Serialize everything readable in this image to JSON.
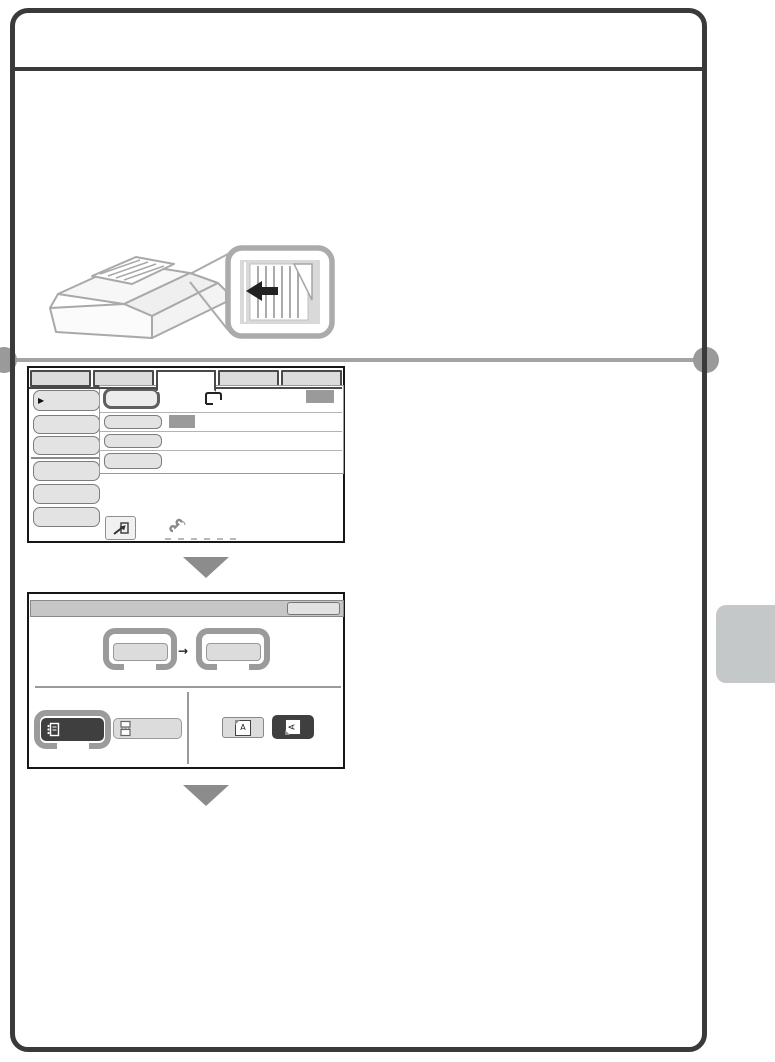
{
  "page": {
    "background": "#ffffff",
    "frame_color": "#3a3a3a",
    "section_divider_color": "#a3a3a3",
    "step_arrow_color": "#8c8c8c",
    "side_tab_color": "#c5c8c9"
  },
  "illustration": {
    "name": "mfp-automatic-document-feeder-with-original",
    "callout_name": "original-placement-detail",
    "callout_arrow_direction": "left",
    "line_color": "#a9a9a9",
    "callout_arrow_color": "#222222"
  },
  "screen1": {
    "name": "fax-base-screen-mockup",
    "tab_count": 5,
    "selected_tab_index": 3,
    "left_menu_button_count": 6,
    "left_menu_marker": "▶",
    "colors": {
      "tab": "#dcdcdc",
      "button": "#e3e3e3",
      "highlight_border": "#5f5f5f",
      "memory_indicator": "#9a9a9a"
    },
    "icons": [
      "original-icon",
      "memory-indicator",
      "redial-key-icon",
      "handset-icon"
    ]
  },
  "screen2": {
    "name": "original-settings-screen-mockup",
    "size_arrow": "→",
    "orientation_letter": "A",
    "colors": {
      "title_bar": "#c6c6c6",
      "key_frame": "#9b9b9b",
      "selected_key": "#3f3f3f",
      "key": "#dcdcdc"
    },
    "icons": [
      "two-sided-booklet-icon",
      "two-sided-tablet-icon",
      "orientation-portrait-icon",
      "orientation-landscape-icon"
    ]
  }
}
